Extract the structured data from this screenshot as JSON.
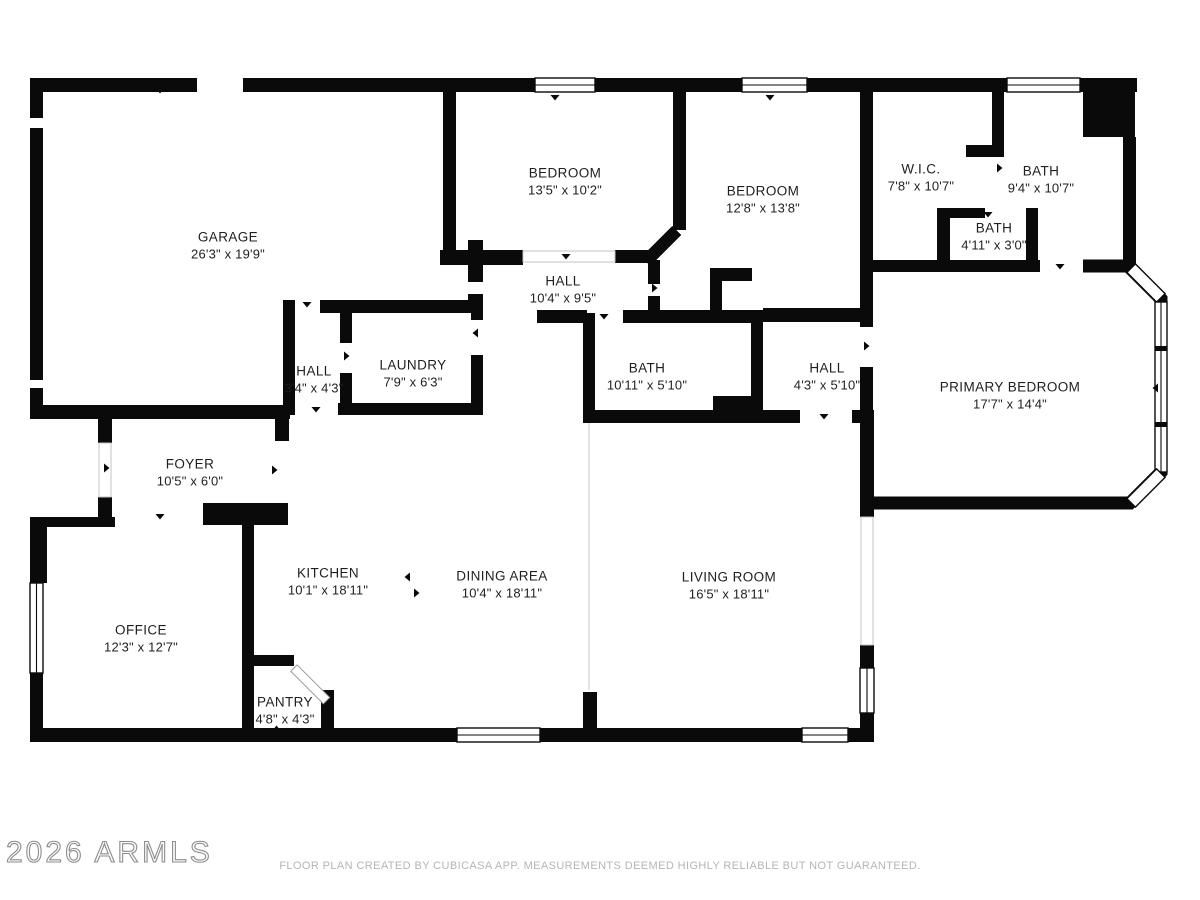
{
  "meta": {
    "watermark": "2026 ARMLS",
    "footer": "FLOOR PLAN CREATED BY CUBICASA APP. MEASUREMENTS DEEMED HIGHLY RELIABLE BUT NOT GUARANTEED."
  },
  "colors": {
    "wall": "#0a0a0a",
    "label_text": "#1f1f1f",
    "footer_text": "#b5b5b5",
    "watermark_outline": "#8d8d8d"
  },
  "rooms": {
    "garage": {
      "name": "GARAGE",
      "dims": "26'3\" x 19'9\""
    },
    "bedroom1": {
      "name": "BEDROOM",
      "dims": "13'5\" x 10'2\""
    },
    "bedroom2": {
      "name": "BEDROOM",
      "dims": "12'8\" x 13'8\""
    },
    "wic": {
      "name": "W.I.C.",
      "dims": "7'8\" x 10'7\""
    },
    "bath_upper": {
      "name": "BATH",
      "dims": "9'4\" x 10'7\""
    },
    "bath_small": {
      "name": "BATH",
      "dims": "4'11\" x 3'0\""
    },
    "hall_upper": {
      "name": "HALL",
      "dims": "10'4\" x 9'5\""
    },
    "hall_small": {
      "name": "HALL",
      "dims": "3'4\" x 4'3\""
    },
    "laundry": {
      "name": "LAUNDRY",
      "dims": "7'9\" x 6'3\""
    },
    "bath_mid": {
      "name": "BATH",
      "dims": "10'11\" x 5'10\""
    },
    "hall_mid": {
      "name": "HALL",
      "dims": "4'3\" x 5'10\""
    },
    "primary_bedroom": {
      "name": "PRIMARY BEDROOM",
      "dims": "17'7\" x 14'4\""
    },
    "foyer": {
      "name": "FOYER",
      "dims": "10'5\" x 6'0\""
    },
    "kitchen": {
      "name": "KITCHEN",
      "dims": "10'1\" x 18'11\""
    },
    "dining": {
      "name": "DINING AREA",
      "dims": "10'4\" x 18'11\""
    },
    "living": {
      "name": "LIVING ROOM",
      "dims": "16'5\" x 18'11\""
    },
    "office": {
      "name": "OFFICE",
      "dims": "12'3\" x 12'7\""
    },
    "pantry": {
      "name": "PANTRY",
      "dims": "4'8\" x 4'3\""
    }
  }
}
